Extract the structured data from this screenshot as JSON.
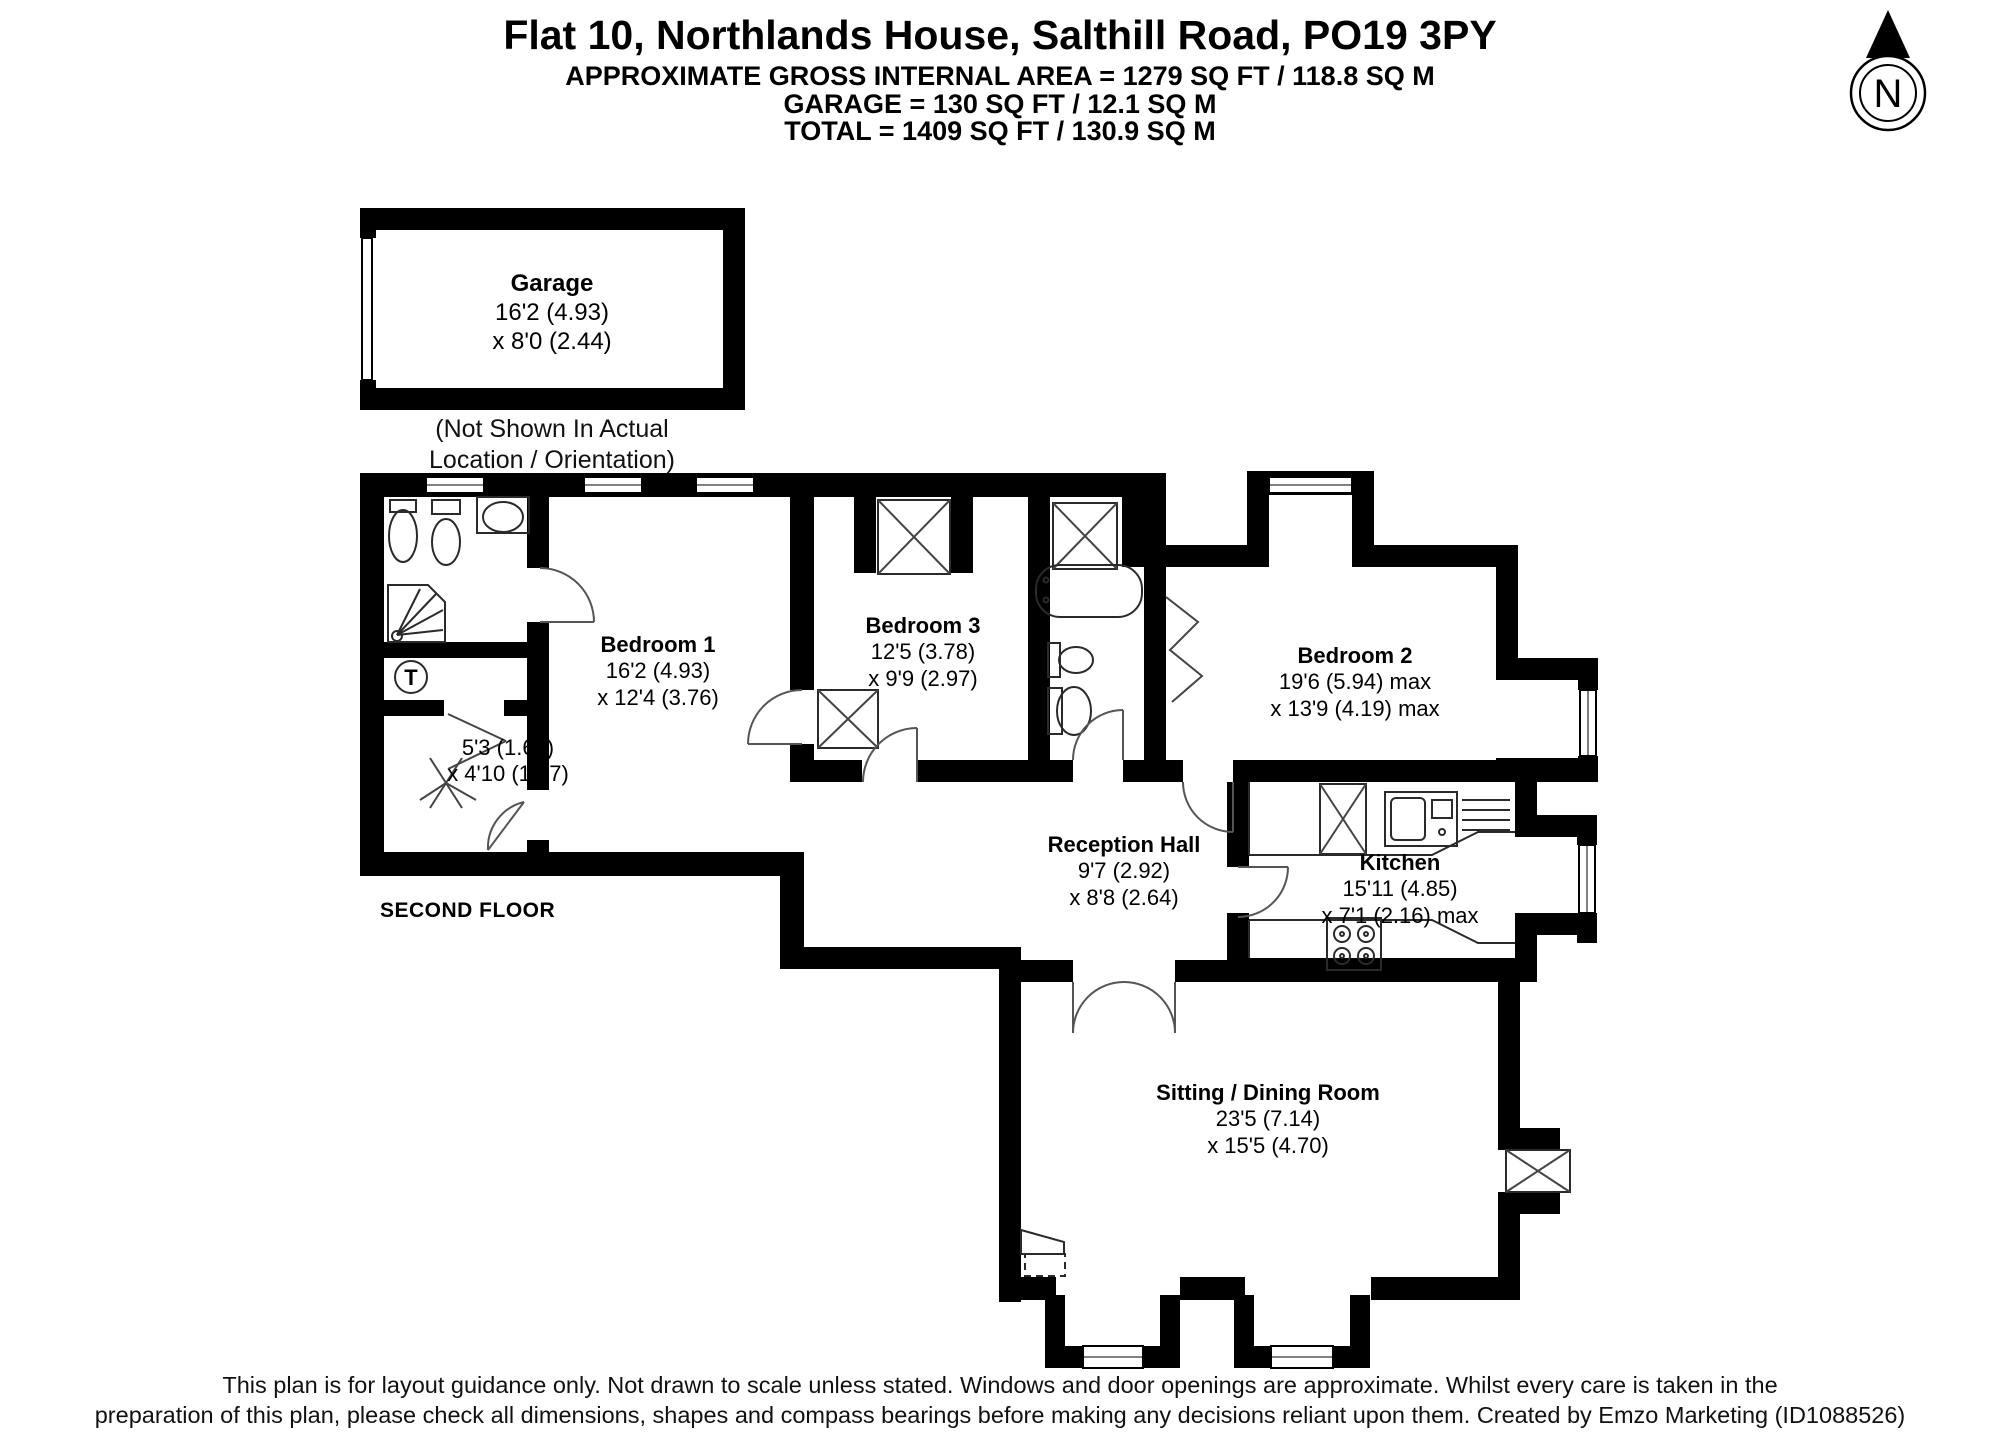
{
  "header": {
    "title": "Flat 10, Northlands House, Salthill Road, PO19 3PY",
    "area_line": "APPROXIMATE GROSS INTERNAL AREA = 1279 SQ FT / 118.8 SQ M",
    "garage_line": "GARAGE = 130 SQ FT / 12.1 SQ M",
    "total_line": "TOTAL = 1409 SQ FT / 130.9 SQ M"
  },
  "compass": {
    "label": "N"
  },
  "garage": {
    "name": "Garage",
    "dim1": "16'2 (4.93)",
    "dim2": "x 8'0 (2.44)",
    "note1": "(Not Shown In Actual",
    "note2": "Location / Orientation)"
  },
  "rooms": {
    "bedroom1": {
      "name": "Bedroom 1",
      "dim1": "16'2 (4.93)",
      "dim2": "x 12'4 (3.76)"
    },
    "bedroom3": {
      "name": "Bedroom 3",
      "dim1": "12'5 (3.78)",
      "dim2": "x 9'9 (2.97)"
    },
    "bedroom2": {
      "name": "Bedroom 2",
      "dim1": "19'6 (5.94) max",
      "dim2": "x 13'9 (4.19) max"
    },
    "reception_hall": {
      "name": "Reception Hall",
      "dim1": "9'7 (2.92)",
      "dim2": "x 8'8 (2.64)"
    },
    "kitchen": {
      "name": "Kitchen",
      "dim1": "15'11 (4.85)",
      "dim2": "x 7'1 (2.16) max"
    },
    "sitting_dining": {
      "name": "Sitting / Dining Room",
      "dim1": "23'5 (7.14)",
      "dim2": "x 15'5 (4.70)"
    },
    "storage": {
      "dim1": "5'3 (1.60)",
      "dim2": "x 4'10 (1.47)"
    }
  },
  "floor_label": "SECOND FLOOR",
  "fixtures": {
    "dryer_label": "T"
  },
  "colors": {
    "wall": "#000000",
    "background": "#ffffff"
  },
  "footer": {
    "line1": "This plan is for layout guidance only. Not drawn to scale unless stated. Windows and door openings are approximate. Whilst every care is taken in the",
    "line2": "preparation of this plan, please check all dimensions, shapes and compass bearings before making any decisions reliant upon them. Created by Emzo Marketing (ID1088526)"
  }
}
